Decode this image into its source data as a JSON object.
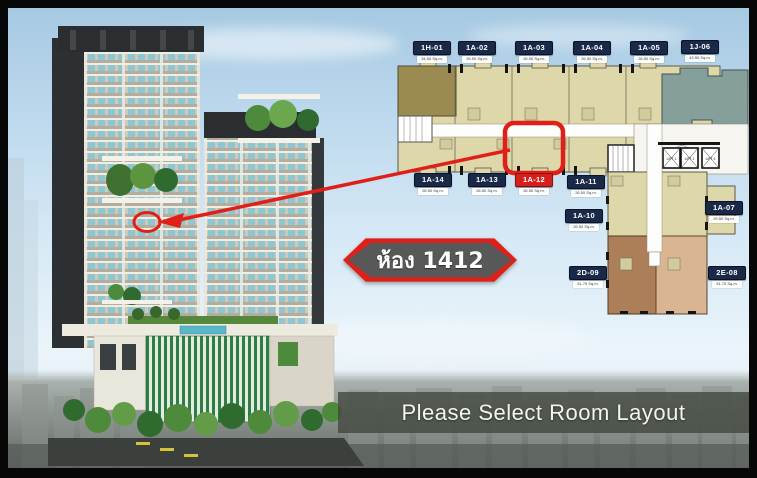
{
  "floor_plan": {
    "selected_unit": "1A-12",
    "units": [
      {
        "id": "1H-01",
        "area": "34.50 Sq.m."
      },
      {
        "id": "1A-02",
        "area": "26.50 Sq.m."
      },
      {
        "id": "1A-03",
        "area": "26.50 Sq.m."
      },
      {
        "id": "1A-04",
        "area": "26.50 Sq.m."
      },
      {
        "id": "1A-05",
        "area": "26.50 Sq.m."
      },
      {
        "id": "1J-06",
        "area": "43.50 Sq.m."
      },
      {
        "id": "1A-14",
        "area": "26.50 Sq.m."
      },
      {
        "id": "1A-13",
        "area": "26.50 Sq.m."
      },
      {
        "id": "1A-12",
        "area": "26.50 Sq.m."
      },
      {
        "id": "1A-11",
        "area": "26.50 Sq.m."
      },
      {
        "id": "1A-10",
        "area": "26.50 Sq.m."
      },
      {
        "id": "1A-07",
        "area": "29.50 Sq.m."
      },
      {
        "id": "2D-09",
        "area": "51.75 Sq.m."
      },
      {
        "id": "2E-08",
        "area": "51.75 Sq.m."
      }
    ],
    "lifts": [
      "LIFT 1",
      "LIFT 2",
      "LIFT 3"
    ]
  },
  "callout": {
    "room_label": "ห้อง 1412"
  },
  "footer": {
    "message": "Please Select Room Layout"
  },
  "colors": {
    "highlight_red": "#e02018",
    "badge_navy": "#1a2947",
    "badge_red": "#d41f1c",
    "plan_beige": "#ded7a9",
    "plan_olive": "#9b8a52",
    "plan_teal": "#85a09b",
    "plan_brown": "#ad7f58",
    "plan_tan": "#d9b691"
  }
}
